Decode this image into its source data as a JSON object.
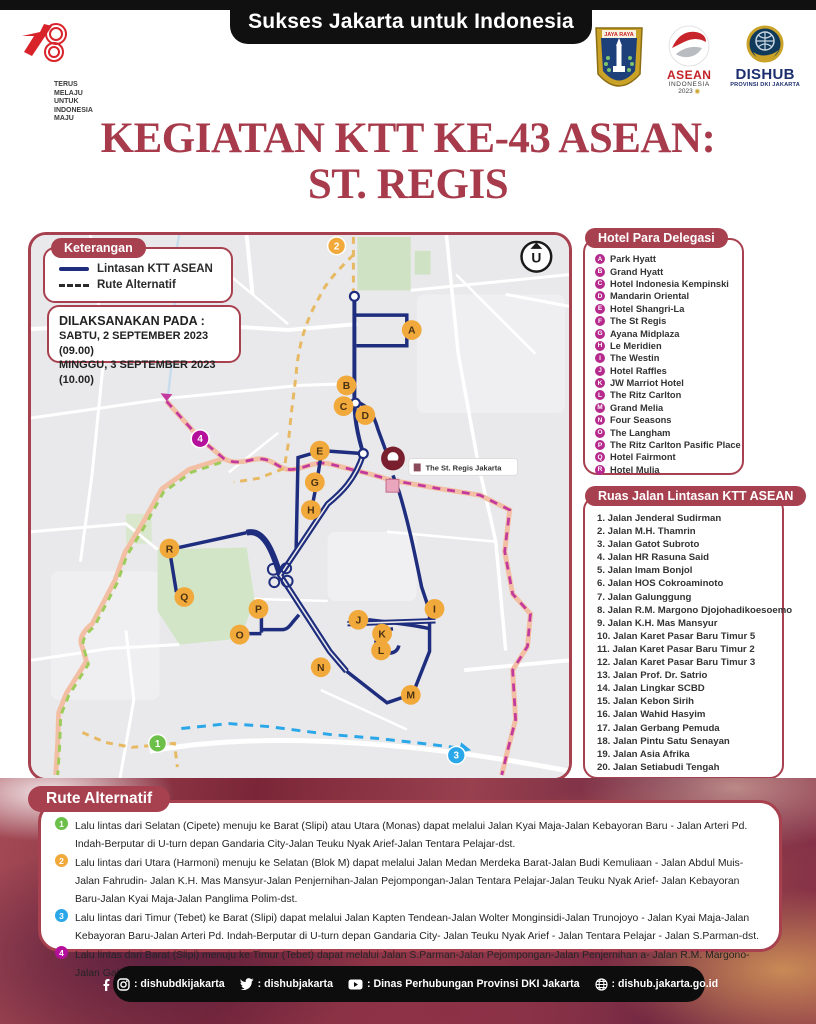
{
  "header": {
    "top_banner": "Sukses Jakarta untuk Indonesia",
    "logo78": {
      "number": "78",
      "tagline": [
        "TERUS",
        "MELAJU",
        "UNTUK",
        "INDONESIA",
        "MAJU"
      ]
    },
    "jakarta_crest_text": "JAYA RAYA",
    "asean_logo": {
      "line1": "ASEAN",
      "line2": "INDONESIA",
      "line3": "2023"
    },
    "dishub_logo": {
      "line1": "DISHUB",
      "line2": "PROVINSI DKI JAKARTA"
    }
  },
  "title": {
    "line1": "KEGIATAN KTT KE-43 ASEAN:",
    "line2": "ST. REGIS"
  },
  "legend": {
    "badge": "Keterangan",
    "items": [
      {
        "label": "Lintasan KTT ASEAN",
        "style": "solid"
      },
      {
        "label": "Rute Alternatif",
        "style": "dashed"
      }
    ]
  },
  "schedule": {
    "heading": "DILAKSANAKAN PADA :",
    "rows": [
      "SABTU, 2 SEPTEMBER 2023 (09.00)",
      "MINGGU, 3 SEPTEMBER 2023 (10.00)"
    ]
  },
  "map": {
    "venue_label": "The St. Regis Jakarta",
    "compass_letter": "U",
    "hotel_markers": [
      {
        "letter": "A",
        "x": 385,
        "y": 96
      },
      {
        "letter": "B",
        "x": 319,
        "y": 152
      },
      {
        "letter": "C",
        "x": 316,
        "y": 173
      },
      {
        "letter": "D",
        "x": 338,
        "y": 182
      },
      {
        "letter": "E",
        "x": 292,
        "y": 218
      },
      {
        "letter": "G",
        "x": 287,
        "y": 250
      },
      {
        "letter": "H",
        "x": 283,
        "y": 278
      },
      {
        "letter": "I",
        "x": 408,
        "y": 378
      },
      {
        "letter": "J",
        "x": 331,
        "y": 389
      },
      {
        "letter": "K",
        "x": 355,
        "y": 403
      },
      {
        "letter": "L",
        "x": 354,
        "y": 420
      },
      {
        "letter": "M",
        "x": 384,
        "y": 465
      },
      {
        "letter": "N",
        "x": 293,
        "y": 437
      },
      {
        "letter": "O",
        "x": 211,
        "y": 404
      },
      {
        "letter": "P",
        "x": 230,
        "y": 378
      },
      {
        "letter": "Q",
        "x": 155,
        "y": 366
      },
      {
        "letter": "R",
        "x": 140,
        "y": 317
      }
    ],
    "route_markers": [
      {
        "n": "1",
        "x": 128,
        "y": 514,
        "color": "#6cc04a"
      },
      {
        "n": "2",
        "x": 309,
        "y": 11,
        "color": "#f2a93b"
      },
      {
        "n": "3",
        "x": 430,
        "y": 526,
        "color": "#2aa7e8"
      },
      {
        "n": "4",
        "x": 171,
        "y": 206,
        "color": "#b5109b"
      }
    ]
  },
  "hotels": {
    "badge": "Hotel Para Delegasi",
    "items": [
      {
        "letter": "A",
        "name": "Park Hyatt"
      },
      {
        "letter": "B",
        "name": "Grand Hyatt"
      },
      {
        "letter": "C",
        "name": "Hotel Indonesia Kempinski"
      },
      {
        "letter": "D",
        "name": "Mandarin Oriental"
      },
      {
        "letter": "E",
        "name": "Hotel Shangri-La"
      },
      {
        "letter": "F",
        "name": "The St Regis"
      },
      {
        "letter": "G",
        "name": "Ayana Midplaza"
      },
      {
        "letter": "H",
        "name": "Le Meridien"
      },
      {
        "letter": "I",
        "name": "The Westin"
      },
      {
        "letter": "J",
        "name": "Hotel Raffles"
      },
      {
        "letter": "K",
        "name": "JW Marriot Hotel"
      },
      {
        "letter": "L",
        "name": "The Ritz Carlton"
      },
      {
        "letter": "M",
        "name": "Grand Melia"
      },
      {
        "letter": "N",
        "name": "Four Seasons"
      },
      {
        "letter": "O",
        "name": "The Langham"
      },
      {
        "letter": "P",
        "name": "The Ritz Carlton Pasific Place"
      },
      {
        "letter": "Q",
        "name": "Hotel Fairmont"
      },
      {
        "letter": "R",
        "name": "Hotel Mulia"
      }
    ]
  },
  "roads": {
    "badge": "Ruas Jalan Lintasan KTT ASEAN",
    "items": [
      "Jalan Jenderal Sudirman",
      "Jalan M.H. Thamrin",
      "Jalan Gatot Subroto",
      "Jalan HR Rasuna Said",
      "Jalan Imam Bonjol",
      "Jalan HOS Cokroaminoto",
      "Jalan Galunggung",
      "Jalan R.M. Margono Djojohadikoesoemo",
      "Jalan K.H. Mas Mansyur",
      "Jalan Karet Pasar Baru Timur 5",
      "Jalan Karet Pasar Baru Timur 2",
      "Jalan Karet Pasar Baru Timur 3",
      "Jalan Prof. Dr. Satrio",
      "Jalan Lingkar SCBD",
      "Jalan Kebon Sirih",
      "Jalan Wahid Hasyim",
      "Jalan Gerbang Pemuda",
      "Jalan Pintu Satu Senayan",
      "Jalan Asia Afrika",
      "Jalan Setiabudi Tengah"
    ]
  },
  "alternatives": {
    "badge": "Rute Alternatif",
    "items": [
      {
        "n": "1",
        "color": "#6cc04a",
        "text": "Lalu lintas dari Selatan (Cipete) menuju ke Barat (Slipi) atau Utara (Monas) dapat melalui Jalan Kyai Maja-Jalan Kebayoran Baru - Jalan Arteri Pd. Indah-Berputar di U-turn depan Gandaria City-Jalan Teuku Nyak Arief-Jalan Tentara Pelajar-dst."
      },
      {
        "n": "2",
        "color": "#f2a93b",
        "text": "Lalu lintas dari Utara (Harmoni) menuju ke Selatan (Blok M) dapat melalui Jalan Medan Merdeka Barat-Jalan Budi Kemuliaan - Jalan Abdul Muis-Jalan Fahrudin- Jalan K.H. Mas Mansyur-Jalan Penjernihan-Jalan Pejompongan-Jalan Tentara Pelajar-Jalan Teuku Nyak Arief- Jalan Kebayoran Baru-Jalan Kyai Maja-Jalan Panglima Polim-dst."
      },
      {
        "n": "3",
        "color": "#2aa7e8",
        "text": "Lalu lintas dari Timur (Tebet) ke Barat (Slipi) dapat melalui Jalan Kapten Tendean-Jalan Wolter Monginsidi-Jalan Trunojoyo - Jalan Kyai Maja-Jalan Kebayoran Baru-Jalan Arteri Pd. Indah-Berputar di U-turn depan Gandaria City- Jalan Teuku Nyak Arief - Jalan Tentara Pelajar - Jalan S.Parman-dst."
      },
      {
        "n": "4",
        "color": "#b5109b",
        "text": "Lalu lintas dari Barat (Slipi) menuju ke Timur (Tebet) dapat melalui Jalan S.Parman-Jalan Pejompongan-Jalan Penjernihan a- Jalan R.M. Margono-Jalan Galunggung-Jalan Dr. Saharjo-Jalan Prof Dr. Soepomo-Jalan MT. Haryono-dst."
      }
    ]
  },
  "footer": {
    "items": [
      {
        "icon": "facebook-instagram",
        "text": ": dishubdkijakarta"
      },
      {
        "icon": "twitter",
        "text": ": dishubjakarta"
      },
      {
        "icon": "youtube",
        "text": ": Dinas Perhubungan Provinsi DKI Jakarta"
      },
      {
        "icon": "globe",
        "text": ": dishub.jakarta.go.id"
      }
    ]
  },
  "colors": {
    "accent_red": "#a8414f",
    "title_red": "#a73b4c",
    "route_navy": "#1e2d7d",
    "hotel_marker_orange": "#f2a93b",
    "hotel_bullet_magenta": "#b52a8c",
    "alt_green": "#6cc04a",
    "alt_orange": "#f2a93b",
    "alt_blue": "#2aa7e8",
    "alt_magenta": "#b5109b"
  }
}
